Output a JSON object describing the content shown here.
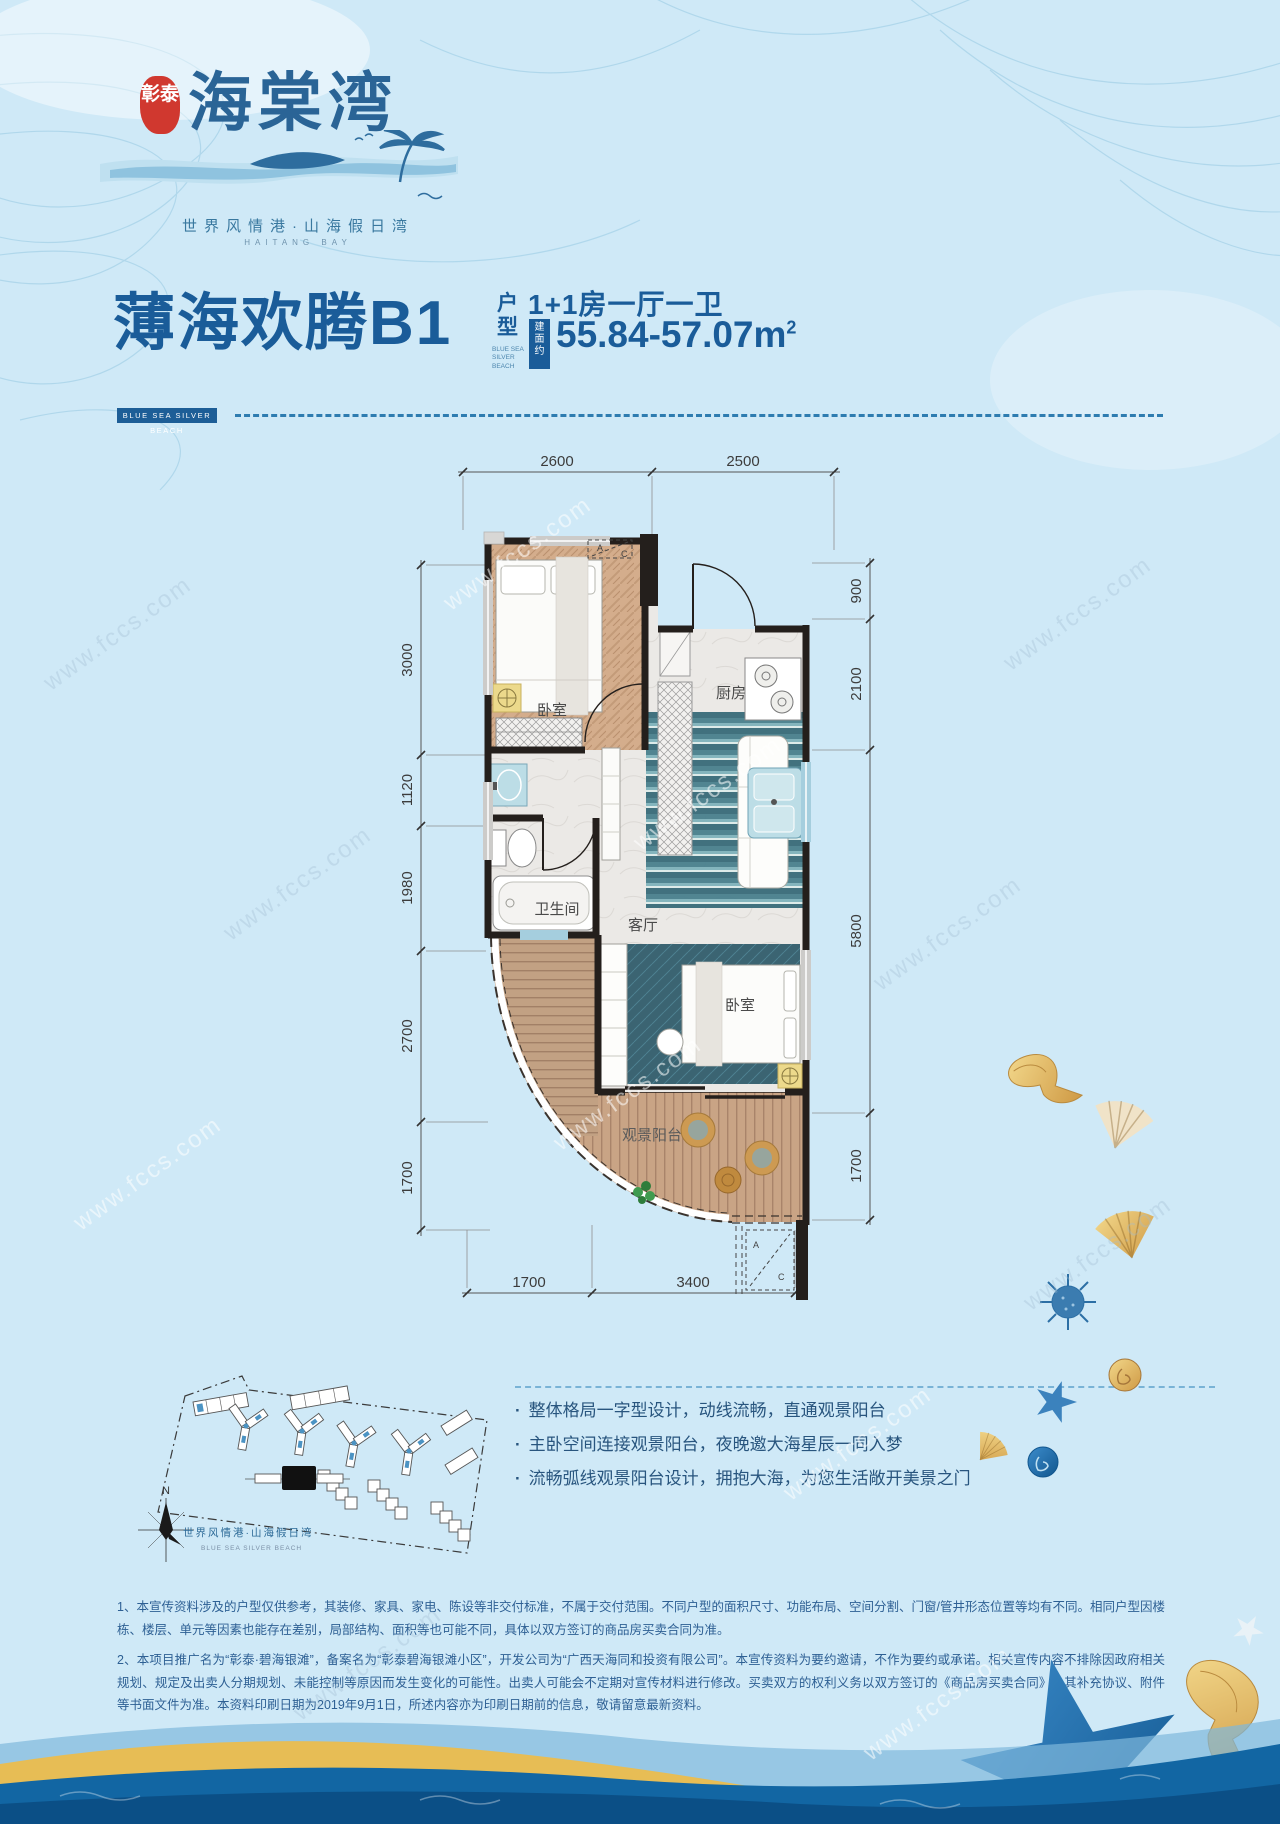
{
  "page": {
    "watermark": "www.fccs.com",
    "bg": "#cfe9f7",
    "accent": "#1a5c99",
    "seal_red": "#d0382f"
  },
  "header": {
    "seal": "彰泰",
    "logo": "海棠湾",
    "tagline": "世界风情港·山海假日湾",
    "tagline_en": "HAITANG BAY"
  },
  "title_block": {
    "title": "薄海欢腾B1",
    "suffix": "户型",
    "suffix_en": "BLUE SEA SILVER BEACH",
    "badge": "BLUE SEA SILVER BEACH",
    "layout": "1+1房一厅一卫",
    "area_badge": "建面约",
    "area": "55.84-57.07m",
    "area_sup": "2"
  },
  "floor_plan": {
    "dims_top": [
      "2600",
      "2500"
    ],
    "dims_left": [
      "3000",
      "1120",
      "1980",
      "2700",
      "1700"
    ],
    "dims_right": [
      "900",
      "2100",
      "5800",
      "1700"
    ],
    "dims_bottom": [
      "1700",
      "3400"
    ],
    "rooms": {
      "bedroom1": "卧室",
      "kitchen": "厨房",
      "bath": "卫生间",
      "living": "客厅",
      "bedroom2": "卧室",
      "balcony": "观景阳台"
    },
    "ac_a": "A",
    "ac_c": "C"
  },
  "site_plan": {
    "north": "N",
    "label": "世界风情港·山海假日湾",
    "label_en": "BLUE SEA SILVER BEACH"
  },
  "features": {
    "bullet": "·",
    "items": [
      "整体格局一字型设计，动线流畅，直通观景阳台",
      "主卧空间连接观景阳台，夜晚邀大海星辰一同入梦",
      "流畅弧线观景阳台设计，拥抱大海，为您生活敞开美景之门"
    ]
  },
  "disclaimer": {
    "p1": "1、本宣传资料涉及的户型仅供参考，其装修、家具、家电、陈设等非交付标准，不属于交付范围。不同户型的面积尺寸、功能布局、空间分割、门窗/管井形态位置等均有不同。相同户型因楼栋、楼层、单元等因素也能存在差别，局部结构、面积等也可能不同，具体以双方签订的商品房买卖合同为准。",
    "p2": "2、本项目推广名为“彰泰·碧海银滩”，备案名为“彰泰碧海银滩小区”，开发公司为“广西天海同和投资有限公司”。本宣传资料为要约邀请，不作为要约或承诺。相关宣传内容不排除因政府相关规划、规定及出卖人分期规划、未能控制等原因而发生变化的可能性。出卖人可能会不定期对宣传材料进行修改。买卖双方的权利义务以双方签订的《商品房买卖合同》及其补充协议、附件等书面文件为准。本资料印刷日期为2019年9月1日，所述内容亦为印刷日期前的信息，敬请留意最新资料。"
  }
}
